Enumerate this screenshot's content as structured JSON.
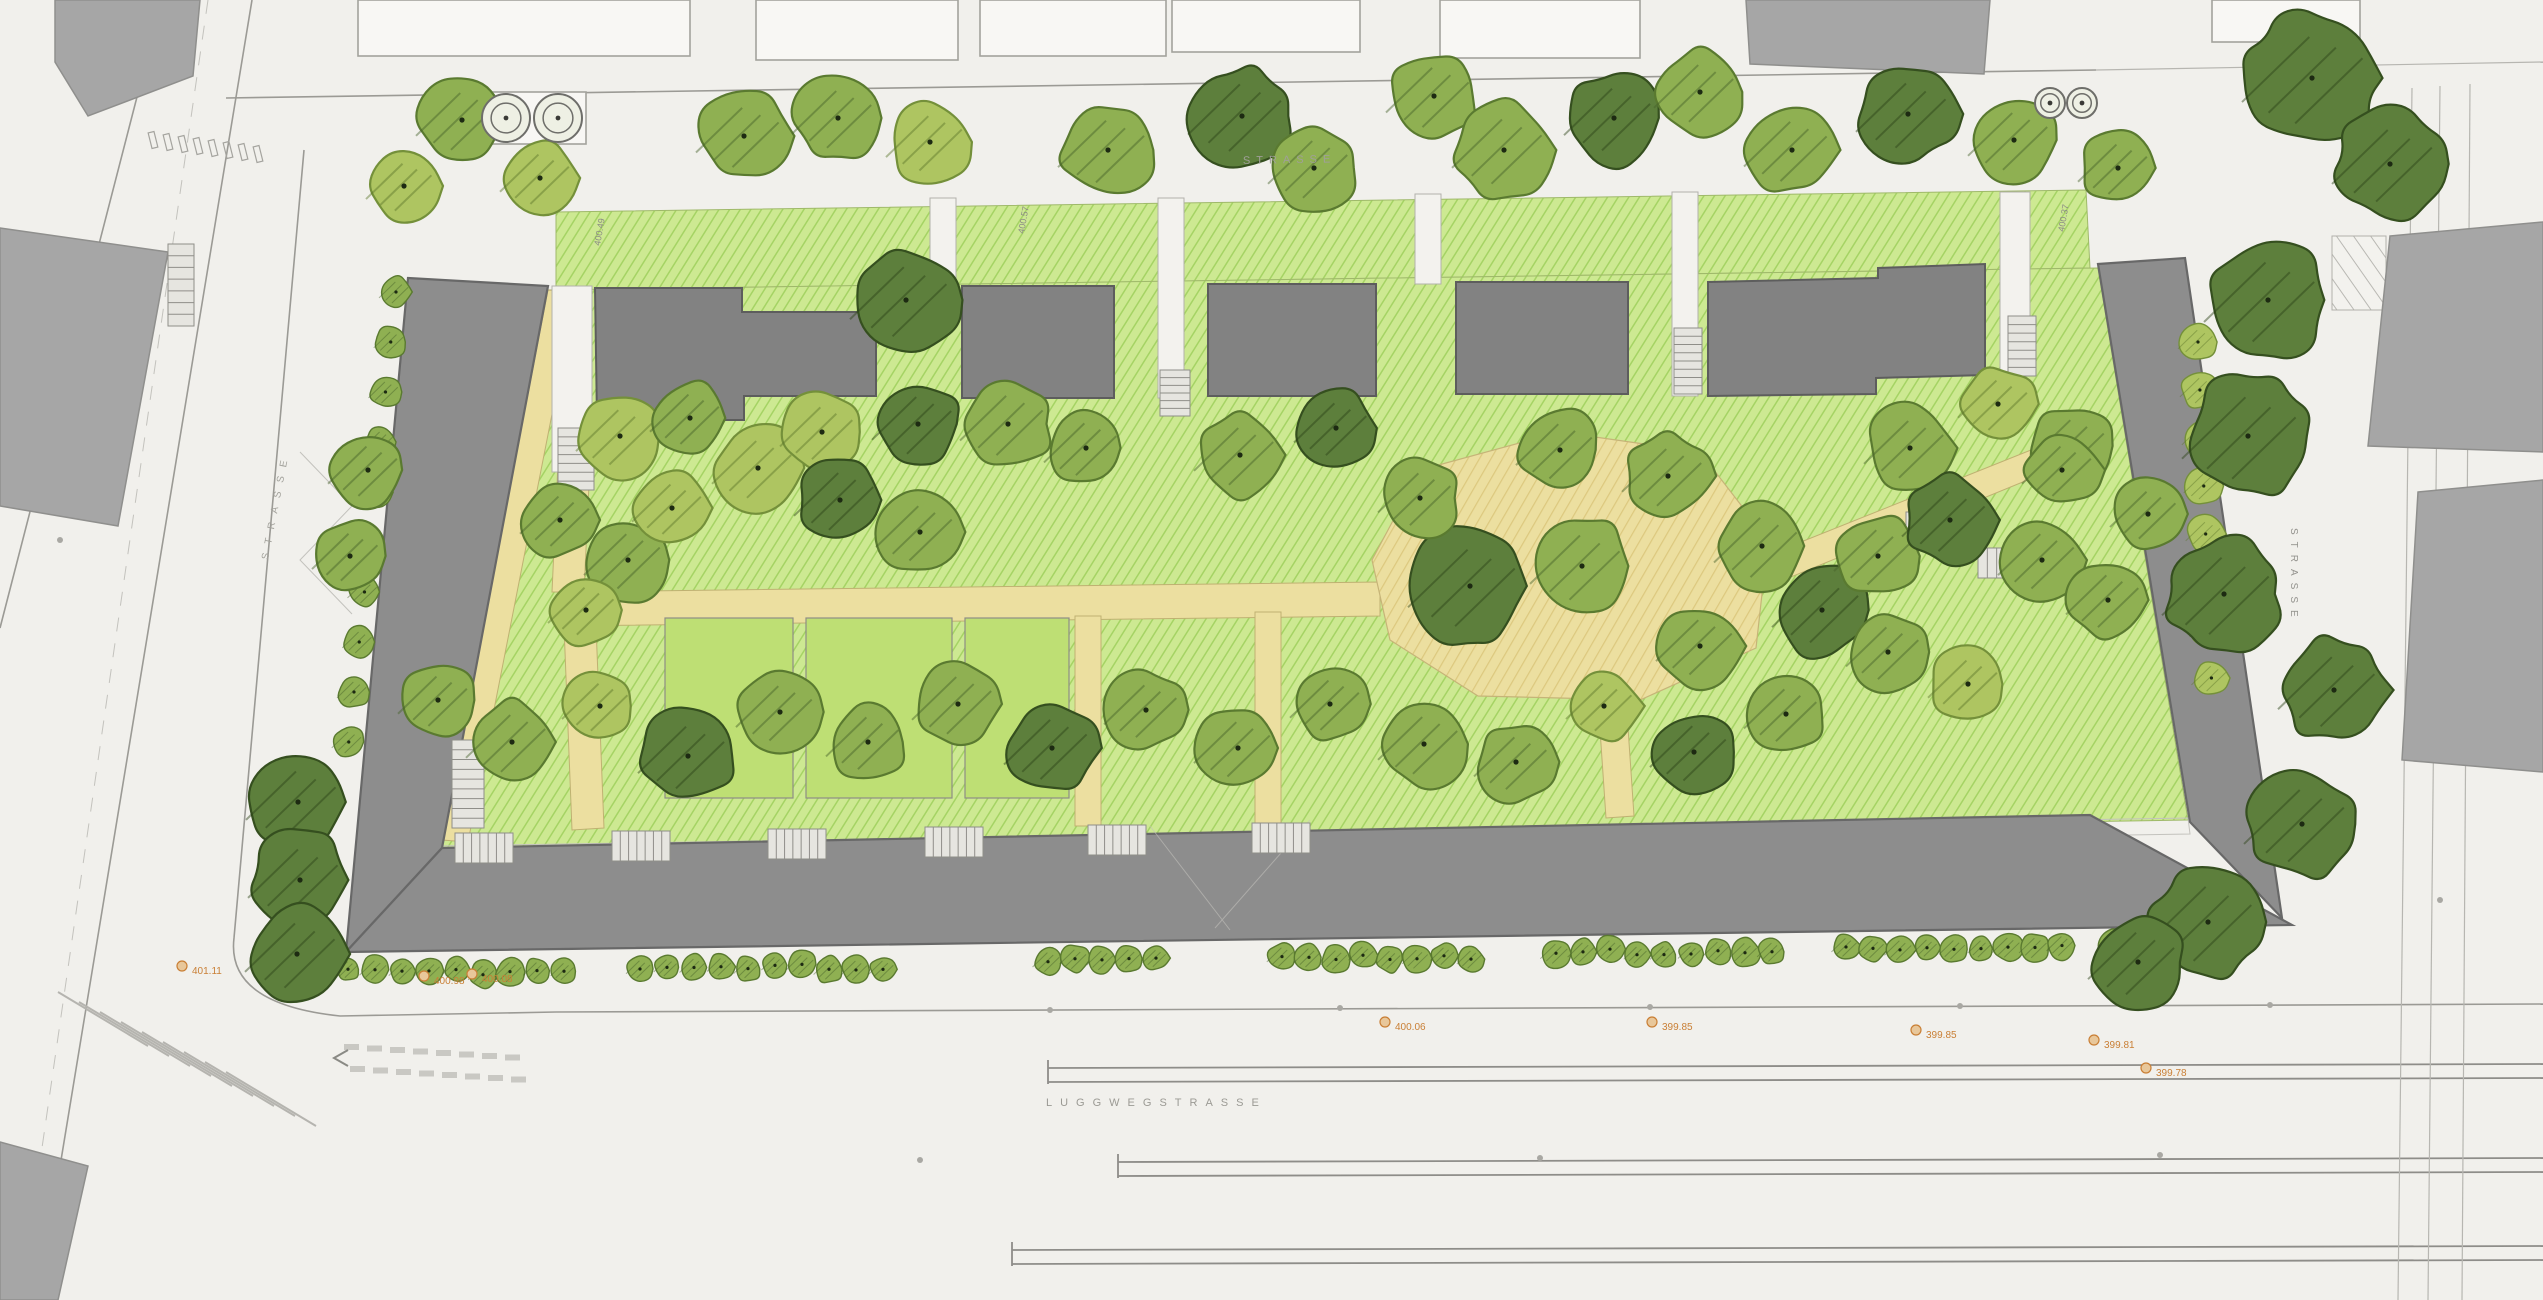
{
  "plan": {
    "street_labels": [
      {
        "text": "LUGGWEGSTRASSE",
        "x": 1046,
        "y": 1106,
        "rotate": 0,
        "spacing": 8,
        "size": 11,
        "color": "#9b9a94"
      },
      {
        "text": "STRASSE",
        "x": 1243,
        "y": 164,
        "rotate": -1,
        "spacing": 6,
        "size": 11,
        "color": "#a09f99"
      },
      {
        "text": "STRASSE",
        "x": 2291,
        "y": 528,
        "rotate": 90,
        "spacing": 7,
        "size": 10,
        "color": "#94938e"
      },
      {
        "text": "STRASSE",
        "x": 268,
        "y": 560,
        "rotate": -79,
        "spacing": 9,
        "size": 10,
        "color": "#a3a29c"
      }
    ],
    "spot_elevations": [
      {
        "x": 182,
        "y": 966,
        "t": "401.11"
      },
      {
        "x": 424,
        "y": 976,
        "t": "400.98"
      },
      {
        "x": 472,
        "y": 974,
        "t": "400.08"
      },
      {
        "x": 1385,
        "y": 1022,
        "t": "400.06"
      },
      {
        "x": 1652,
        "y": 1022,
        "t": "399.85"
      },
      {
        "x": 1916,
        "y": 1030,
        "t": "399.85"
      },
      {
        "x": 2094,
        "y": 1040,
        "t": "399.81"
      },
      {
        "x": 2146,
        "y": 1068,
        "t": "399.78"
      }
    ],
    "garden_elevations": [
      {
        "x": 600,
        "y": 246,
        "t": "400.49",
        "rotate": -80
      },
      {
        "x": 1024,
        "y": 234,
        "t": "400.57",
        "rotate": -80
      },
      {
        "x": 2064,
        "y": 232,
        "t": "400.37",
        "rotate": -80
      }
    ],
    "tree_colors": {
      "L": {
        "fill": "#aec561",
        "stroke": "#74903a",
        "dark": "#5d772c"
      },
      "M": {
        "fill": "#8fb052",
        "stroke": "#5a7a30",
        "dark": "#46612a"
      },
      "D": {
        "fill": "#5d7f3c",
        "stroke": "#354f1f",
        "dark": "#2c4318"
      }
    },
    "trees": [
      [
        462,
        120,
        46,
        "M"
      ],
      [
        404,
        186,
        38,
        "L"
      ],
      [
        540,
        178,
        40,
        "L"
      ],
      [
        744,
        136,
        48,
        "M"
      ],
      [
        838,
        118,
        46,
        "M"
      ],
      [
        930,
        142,
        44,
        "L"
      ],
      [
        1108,
        150,
        50,
        "M"
      ],
      [
        1242,
        116,
        54,
        "D"
      ],
      [
        1314,
        168,
        46,
        "M"
      ],
      [
        1434,
        96,
        48,
        "M"
      ],
      [
        1504,
        150,
        52,
        "M"
      ],
      [
        1614,
        118,
        50,
        "D"
      ],
      [
        1700,
        92,
        46,
        "M"
      ],
      [
        1792,
        150,
        48,
        "M"
      ],
      [
        1908,
        114,
        52,
        "D"
      ],
      [
        2014,
        140,
        46,
        "M"
      ],
      [
        2118,
        168,
        40,
        "M"
      ],
      [
        906,
        300,
        56,
        "D"
      ],
      [
        2312,
        78,
        70,
        "D"
      ],
      [
        2390,
        164,
        58,
        "D"
      ],
      [
        2268,
        300,
        64,
        "D"
      ],
      [
        2248,
        436,
        66,
        "D"
      ],
      [
        2224,
        594,
        62,
        "D"
      ],
      [
        2334,
        690,
        56,
        "D"
      ],
      [
        2302,
        824,
        58,
        "D"
      ],
      [
        2208,
        922,
        60,
        "D"
      ],
      [
        2138,
        962,
        50,
        "D"
      ],
      [
        298,
        802,
        52,
        "D"
      ],
      [
        300,
        880,
        52,
        "D"
      ],
      [
        297,
        954,
        52,
        "D"
      ],
      [
        620,
        436,
        44,
        "L"
      ],
      [
        690,
        418,
        40,
        "M"
      ],
      [
        758,
        468,
        46,
        "L"
      ],
      [
        822,
        432,
        42,
        "L"
      ],
      [
        918,
        424,
        46,
        "D"
      ],
      [
        1008,
        424,
        48,
        "M"
      ],
      [
        1086,
        448,
        42,
        "M"
      ],
      [
        1240,
        455,
        46,
        "M"
      ],
      [
        1336,
        428,
        42,
        "D"
      ],
      [
        1560,
        450,
        44,
        "M"
      ],
      [
        1910,
        448,
        46,
        "M"
      ],
      [
        1998,
        404,
        40,
        "L"
      ],
      [
        2072,
        446,
        44,
        "M"
      ],
      [
        560,
        520,
        40,
        "M"
      ],
      [
        628,
        560,
        44,
        "M"
      ],
      [
        586,
        610,
        38,
        "L"
      ],
      [
        672,
        508,
        40,
        "L"
      ],
      [
        840,
        500,
        46,
        "D"
      ],
      [
        920,
        532,
        44,
        "M"
      ],
      [
        368,
        470,
        40,
        "M"
      ],
      [
        350,
        556,
        38,
        "M"
      ],
      [
        1470,
        586,
        62,
        "D"
      ],
      [
        1582,
        566,
        52,
        "M"
      ],
      [
        1420,
        498,
        42,
        "M"
      ],
      [
        1668,
        476,
        46,
        "M"
      ],
      [
        1762,
        546,
        48,
        "M"
      ],
      [
        1700,
        646,
        44,
        "M"
      ],
      [
        1822,
        610,
        50,
        "D"
      ],
      [
        1878,
        556,
        44,
        "M"
      ],
      [
        1950,
        520,
        48,
        "D"
      ],
      [
        2042,
        560,
        44,
        "M"
      ],
      [
        2108,
        600,
        42,
        "M"
      ],
      [
        1888,
        652,
        42,
        "M"
      ],
      [
        1968,
        684,
        40,
        "L"
      ],
      [
        2148,
        514,
        38,
        "M"
      ],
      [
        2062,
        470,
        40,
        "M"
      ],
      [
        438,
        700,
        40,
        "M"
      ],
      [
        512,
        742,
        46,
        "M"
      ],
      [
        600,
        706,
        38,
        "L"
      ],
      [
        688,
        756,
        50,
        "D"
      ],
      [
        780,
        712,
        44,
        "M"
      ],
      [
        868,
        742,
        42,
        "M"
      ],
      [
        958,
        704,
        46,
        "M"
      ],
      [
        1052,
        748,
        48,
        "D"
      ],
      [
        1146,
        710,
        42,
        "M"
      ],
      [
        1238,
        748,
        44,
        "M"
      ],
      [
        1330,
        704,
        40,
        "M"
      ],
      [
        1424,
        744,
        46,
        "M"
      ],
      [
        1516,
        762,
        42,
        "M"
      ],
      [
        1604,
        706,
        38,
        "L"
      ],
      [
        1694,
        752,
        44,
        "D"
      ],
      [
        1786,
        714,
        42,
        "M"
      ]
    ],
    "hedge_rows": [
      [
        348,
        575,
        972
      ],
      [
        640,
        905,
        967
      ],
      [
        1048,
        1178,
        960
      ],
      [
        1282,
        1480,
        957
      ],
      [
        1556,
        1780,
        952
      ],
      [
        1846,
        2078,
        947
      ],
      [
        2112,
        2232,
        943
      ]
    ],
    "hedge_left": {
      "x": 396,
      "y1": 292,
      "y2": 770,
      "step": 50,
      "dx": -0.105,
      "r": 17
    },
    "hedge_right": {
      "x": 2198,
      "y1": 342,
      "y2": 710,
      "step": 48,
      "dx": 0.04,
      "r": 20
    },
    "stairs": [
      [
        558,
        428,
        36,
        62,
        "v",
        7
      ],
      [
        1160,
        370,
        30,
        46,
        "v",
        6
      ],
      [
        1674,
        328,
        28,
        66,
        "v",
        8
      ],
      [
        2008,
        316,
        28,
        60,
        "v",
        7
      ],
      [
        452,
        740,
        32,
        88,
        "v",
        9
      ],
      [
        168,
        244,
        26,
        82,
        "v",
        7
      ],
      [
        455,
        833,
        58,
        30,
        "h",
        7
      ],
      [
        612,
        831,
        58,
        30,
        "h",
        7
      ],
      [
        768,
        829,
        58,
        30,
        "h",
        7
      ],
      [
        925,
        827,
        58,
        30,
        "h",
        7
      ],
      [
        1088,
        825,
        58,
        30,
        "h",
        7
      ],
      [
        1252,
        823,
        58,
        30,
        "h",
        7
      ],
      [
        1906,
        512,
        62,
        26,
        "h",
        7
      ],
      [
        1978,
        548,
        56,
        30,
        "h",
        6
      ]
    ],
    "tree_grates": [
      {
        "x": 506,
        "y": 118,
        "r": 24
      },
      {
        "x": 558,
        "y": 118,
        "r": 24
      },
      {
        "x": 2050,
        "y": 103,
        "r": 15
      },
      {
        "x": 2082,
        "y": 103,
        "r": 15
      }
    ],
    "accent_orange": "#c97f35",
    "micro_text_gray": "#8a8a85"
  }
}
